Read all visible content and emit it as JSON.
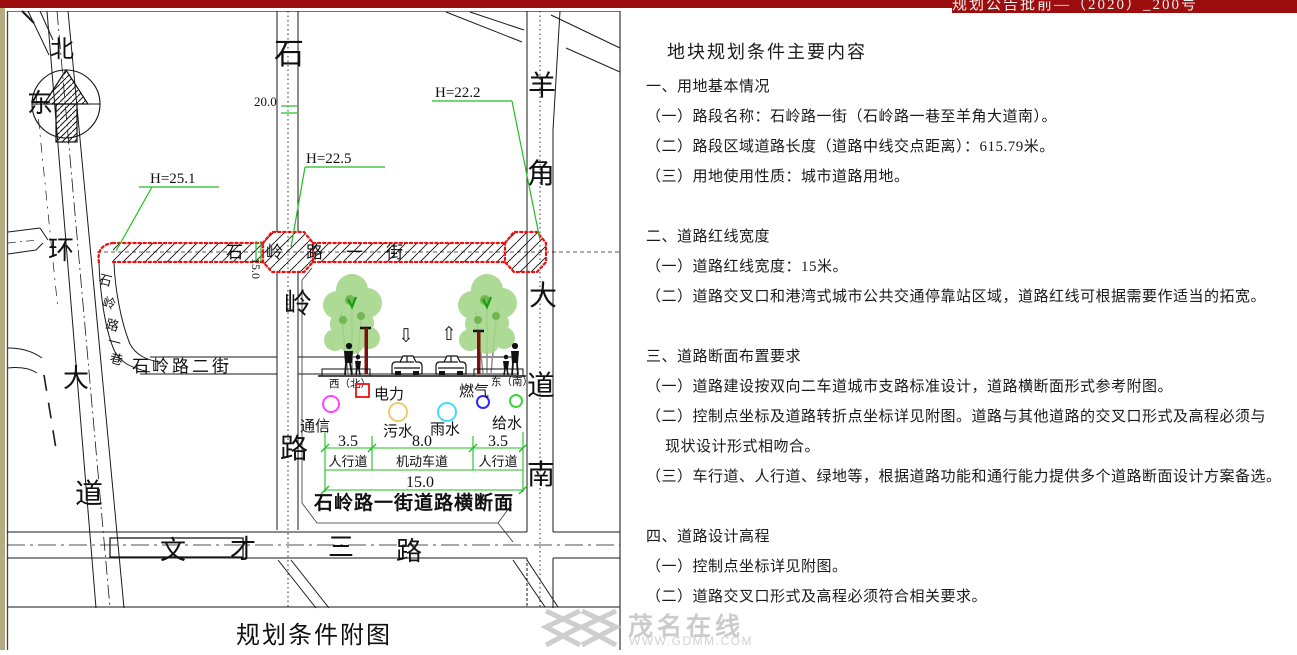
{
  "banner": {
    "doc_number": "规划公告批前—（2020）_200号"
  },
  "map": {
    "frame_title": "规划条件附图",
    "compass": {
      "north": "北"
    },
    "labels": {
      "east_ring": [
        "东",
        "环",
        "大",
        "道"
      ],
      "shiling_road": [
        "石",
        "岭",
        "路"
      ],
      "yangjiao_avenue": [
        "羊",
        "角",
        "大",
        "道",
        "南"
      ],
      "shiling_street_1": "石岭路一街",
      "shiling_lane_1": [
        "石",
        "岭",
        "路",
        "一",
        "巷"
      ],
      "shiling_street_2": "石岭路二街",
      "wencai_road_3": [
        "文",
        "才",
        "三",
        "路"
      ],
      "h_mark_1": "H=25.1",
      "h_mark_2": "H=22.5",
      "h_mark_3": "H=22.2",
      "dim_20": "20.0",
      "dim_15_vertical": "15.0"
    },
    "colors": {
      "red_line": "#ee1111",
      "green_dim": "#1fbf1f"
    }
  },
  "cross_section": {
    "title": "石岭路一街道路横断面",
    "west_label": "西（北）",
    "east_label": "东（南）",
    "arrow_down": "⇩",
    "arrow_up": "⇧",
    "legend": {
      "power": "电力",
      "telecom": "通信",
      "sewage": "污水",
      "storm": "雨水",
      "gas": "燃气",
      "water": "给水"
    },
    "legend_colors": {
      "power": "#ee1111",
      "telecom": "#ff44ff",
      "sewage": "#f0c878",
      "storm": "#41dff5",
      "gas": "#2b2bff",
      "water": "#3fd43f"
    },
    "dims": {
      "left": "3.5",
      "mid": "8.0",
      "right": "3.5",
      "total": "15.0"
    },
    "lanes": {
      "left": "人行道",
      "mid": "机动车道",
      "right": "人行道"
    }
  },
  "panel": {
    "title": "地块规划条件主要内容",
    "lines": [
      "一、用地基本情况",
      "（一）路段名称：石岭路一街（石岭路一巷至羊角大道南）。",
      "（二）路段区域道路长度（道路中线交点距离）：615.79米。",
      "（三）用地使用性质：城市道路用地。",
      "二、道路红线宽度",
      "（一）道路红线宽度：15米。",
      "（二）道路交叉口和港湾式城市公共交通停靠站区域，道路红线可根据需要作适当的拓宽。",
      "三、道路断面布置要求",
      "（一）道路建设按双向二车道城市支路标准设计，道路横断面形式参考附图。",
      "（二）控制点坐标及道路转折点坐标详见附图。道路与其他道路的交叉口形式及高程必须与",
      "现状设计形式相吻合。",
      "（三）车行道、人行道、绿地等，根据道路功能和通行能力提供多个道路断面设计方案备选。",
      "四、道路设计高程",
      "（一）控制点坐标详见附图。",
      "（二）道路交叉口形式及高程必须符合相关要求。"
    ]
  },
  "watermark": {
    "name": "茂名在线",
    "url": "WWW.GDMM.COM"
  }
}
